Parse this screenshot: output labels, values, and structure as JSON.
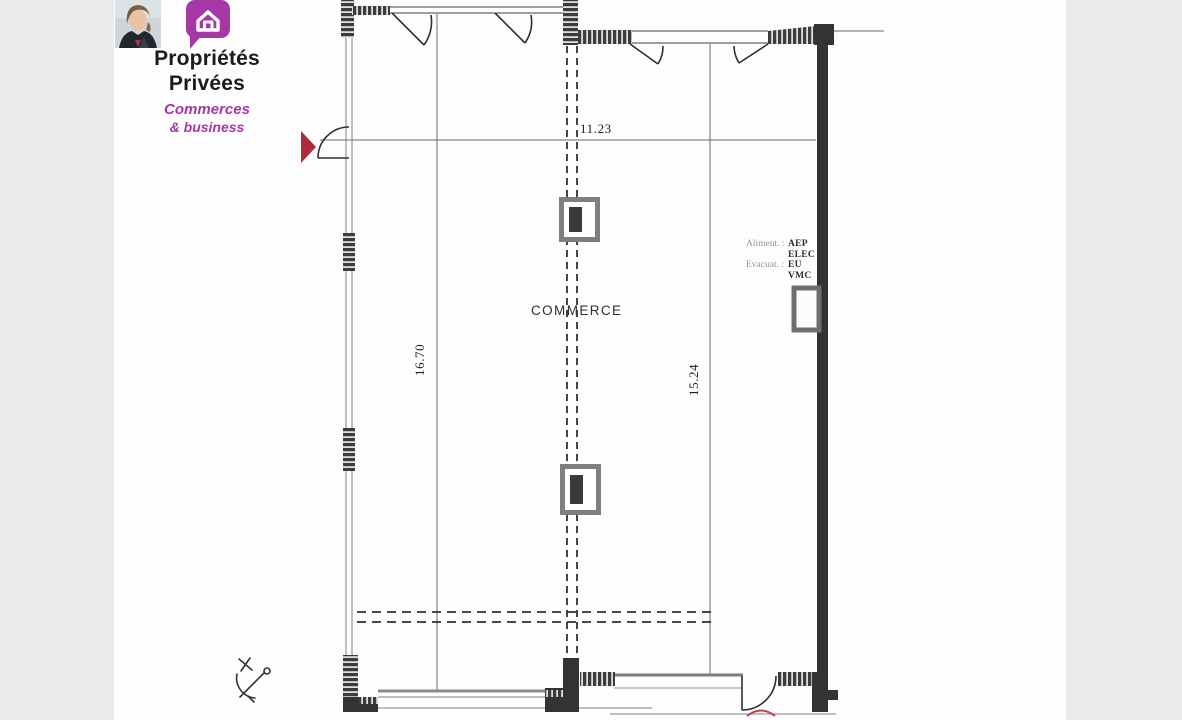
{
  "brand": {
    "name_line1": "Propriétés",
    "name_line2": "Privées",
    "sub_line1": "Commerces",
    "sub_line2": "& business"
  },
  "plan": {
    "room_label": "COMMERCE",
    "dimensions": {
      "top_width": "11.23",
      "left_height": "16.70",
      "right_height": "15.24"
    },
    "utilities": {
      "rows": [
        {
          "label": "Aliment. :",
          "value": "AEP"
        },
        {
          "label": "",
          "value": "ELEC"
        },
        {
          "label": "Evacuat. :",
          "value": "EU"
        },
        {
          "label": "",
          "value": "VMC"
        }
      ]
    }
  },
  "colors": {
    "brand_purple": "#a538a5",
    "entrance_marker_red": "#b02a3e",
    "wall_dark": "#383838",
    "page_gray": "#e9eaea"
  }
}
